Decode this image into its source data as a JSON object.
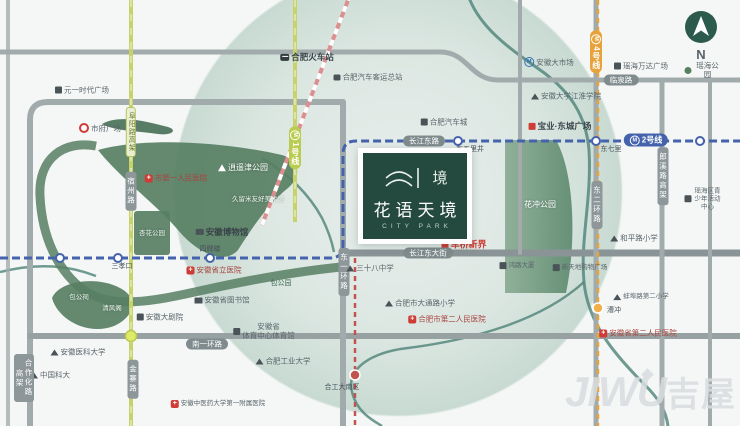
{
  "project": {
    "name_cn": "花语天境",
    "name_en": "CITY PARK",
    "glyph_char": "境"
  },
  "compass": {
    "label": "N"
  },
  "watermark": {
    "en": "JIWU",
    "cn": "吉屋"
  },
  "colors": {
    "brand_green": "#24493f",
    "circle_tint": "#a9c6ba",
    "park_green": "#577f63",
    "road_gray": "#a2abac",
    "road_dark": "#7f8b8d",
    "metro_blue": "#4463ac",
    "line4_orange": "#e7a33b",
    "line5_red": "#c25450",
    "elevated_olive": "#c7d26a",
    "poi_red": "#cf3b35",
    "water_teal": "#4e8277"
  },
  "map": {
    "labels": [
      {
        "n": "hefei-railway-station",
        "t": "合肥火车站",
        "x": 307,
        "y": 57,
        "c": "poi-strong",
        "i": "train"
      },
      {
        "n": "coach-terminal",
        "t": "合肥汽车客运总站",
        "x": 368,
        "y": 77,
        "i": "bus"
      },
      {
        "n": "yuanyi-plaza",
        "t": "元一时代广场",
        "x": 82,
        "y": 90,
        "i": "building"
      },
      {
        "n": "city-hall-square",
        "t": "市府广场",
        "x": 100,
        "y": 128,
        "i": "target"
      },
      {
        "n": "anhui-big-market",
        "t": "安徽大市场",
        "x": 549,
        "y": 62,
        "i": "metro"
      },
      {
        "n": "yaohai-wanda-plaza",
        "t": "瑶海万达广场",
        "x": 641,
        "y": 66,
        "i": "building"
      },
      {
        "n": "yaohai-park",
        "t": "瑶海公园",
        "x": 703,
        "y": 70,
        "i": "tree"
      },
      {
        "n": "linquan-road-box",
        "t": "临泉路",
        "x": 621,
        "y": 80,
        "c": "roadbox"
      },
      {
        "n": "anhui-univ-jianghuai-college",
        "t": "安徽大学江淮学院",
        "x": 566,
        "y": 96,
        "i": "school"
      },
      {
        "n": "hefei-auto-city",
        "t": "合肥汽车城",
        "x": 444,
        "y": 122,
        "i": "building"
      },
      {
        "n": "baoye-dongcheng-plaza",
        "t": "宝业·东城广场",
        "x": 560,
        "y": 126,
        "c": "poi-strong",
        "i": "building-red"
      },
      {
        "n": "line1-badge",
        "t": "1号线",
        "x": 295,
        "y": 148,
        "c": "badge-olive-v",
        "i": "m-white"
      },
      {
        "n": "fuyang-elevated-box",
        "t": "阜阳路高架",
        "x": 131,
        "y": 132,
        "c": "roadbox-olive-v"
      },
      {
        "n": "changjiang-east-road-box",
        "t": "长江东路",
        "x": 424,
        "y": 141,
        "c": "roadbox"
      },
      {
        "n": "line2-badge",
        "t": "2号线",
        "x": 646,
        "y": 140,
        "c": "badge-blue",
        "i": "m-white"
      },
      {
        "n": "dongqili-station-label",
        "t": "东七里",
        "x": 611,
        "y": 150,
        "c": "station"
      },
      {
        "n": "dongwulijing-station-label",
        "t": "东五里井",
        "x": 470,
        "y": 150,
        "c": "station"
      },
      {
        "n": "line4-badge",
        "t": "4号线",
        "x": 596,
        "y": 52,
        "c": "badge-orange-v",
        "i": "m-white"
      },
      {
        "n": "huachong-park-label",
        "t": "花冲公园",
        "x": 540,
        "y": 205,
        "c": "park"
      },
      {
        "n": "yaohai-youth-center",
        "t": "瑶海区青少年活动中心",
        "x": 703,
        "y": 199,
        "c": "tiny",
        "i": "building"
      },
      {
        "n": "langxi-elevated-box",
        "t": "郎溪路高架",
        "x": 663,
        "y": 176,
        "c": "roadbox-v"
      },
      {
        "n": "east-2nd-ring-box",
        "t": "东二环路",
        "x": 597,
        "y": 205,
        "c": "roadbox-v"
      },
      {
        "n": "east-1st-ring-box",
        "t": "东一环路",
        "x": 344,
        "y": 272,
        "c": "roadbox-v"
      },
      {
        "n": "suzhou-road-box",
        "t": "宿州路",
        "x": 131,
        "y": 191,
        "c": "roadbox-v"
      },
      {
        "n": "xiaoyaojin-park-label",
        "t": "逍遥津公园",
        "x": 243,
        "y": 168,
        "c": "park",
        "i": "tree-white"
      },
      {
        "n": "kurume-art-museum",
        "t": "久留米友好美术馆",
        "x": 258,
        "y": 200,
        "c": "park-sub"
      },
      {
        "n": "hefei-1st-peoples-hospital",
        "t": "市第一人民医院",
        "x": 176,
        "y": 178,
        "c": "poi-red",
        "i": "hospital"
      },
      {
        "n": "xinghua-park-label",
        "t": "杏花公园",
        "x": 152,
        "y": 234,
        "c": "park-sub"
      },
      {
        "n": "anhui-museum",
        "t": "安徽博物馆",
        "x": 222,
        "y": 232,
        "c": "poi-strong",
        "i": "museum"
      },
      {
        "n": "cheqiao-xinjie",
        "t": "车桥新界",
        "x": 464,
        "y": 245,
        "c": "red-strong",
        "i": "building-red"
      },
      {
        "n": "changjiang-east-avenue-box",
        "t": "长江东大街",
        "x": 428,
        "y": 253,
        "c": "roadbox"
      },
      {
        "n": "no38-middle-school",
        "t": "三十八中学",
        "x": 370,
        "y": 268,
        "i": "school"
      },
      {
        "n": "honglu-tower",
        "t": "鸿路大厦",
        "x": 517,
        "y": 266,
        "c": "tiny",
        "i": "building"
      },
      {
        "n": "xintiandi-mall",
        "t": "新天地购物广场",
        "x": 580,
        "y": 268,
        "c": "tiny",
        "i": "building"
      },
      {
        "n": "heping-road-primary",
        "t": "和平路小学",
        "x": 634,
        "y": 238,
        "i": "school"
      },
      {
        "n": "bengbu-road-2nd-primary",
        "t": "蚌埠路第二小学",
        "x": 641,
        "y": 297,
        "c": "tiny",
        "i": "school"
      },
      {
        "n": "datong-road-primary",
        "t": "合肥市大通路小学",
        "x": 420,
        "y": 303,
        "i": "school"
      },
      {
        "n": "hefei-2nd-peoples-hospital",
        "t": "合肥市第二人民医院",
        "x": 447,
        "y": 319,
        "c": "poi-red",
        "i": "hospital"
      },
      {
        "n": "anhui-2nd-peoples-hospital",
        "t": "安徽省第二人民医院",
        "x": 638,
        "y": 333,
        "c": "poi-red",
        "i": "hospital"
      },
      {
        "n": "caochong-station-label",
        "t": "漕冲",
        "x": 614,
        "y": 311,
        "c": "station"
      },
      {
        "n": "anhui-provincial-hospital",
        "t": "安徽省立医院",
        "x": 214,
        "y": 270,
        "c": "poi-red",
        "i": "hospital"
      },
      {
        "n": "sipailou-station-label",
        "t": "四牌楼",
        "x": 210,
        "y": 250,
        "c": "station"
      },
      {
        "n": "sanxiaokou-station-label",
        "t": "三孝口",
        "x": 122,
        "y": 267,
        "c": "station"
      },
      {
        "n": "anhui-library",
        "t": "安徽省图书馆",
        "x": 222,
        "y": 300,
        "i": "museum"
      },
      {
        "n": "baogong-park-label",
        "t": "包公园",
        "x": 281,
        "y": 284,
        "c": "park-dark"
      },
      {
        "n": "baogong-temple-label",
        "t": "包公祠",
        "x": 79,
        "y": 298,
        "c": "park-sub"
      },
      {
        "n": "qingfeng-pavilion-label",
        "t": "清风阁",
        "x": 112,
        "y": 309,
        "c": "park-sub"
      },
      {
        "n": "anhui-grand-theatre",
        "t": "安徽大剧院",
        "x": 160,
        "y": 317,
        "i": "building"
      },
      {
        "n": "sports-center-gym",
        "t": "安徽省\n体育中心体育馆",
        "x": 264,
        "y": 331,
        "i": "building"
      },
      {
        "n": "south-1st-ring-box",
        "t": "南一环路",
        "x": 207,
        "y": 344,
        "c": "roadbox"
      },
      {
        "n": "hefei-univ-tech",
        "t": "合肥工业大学",
        "x": 283,
        "y": 361,
        "i": "school"
      },
      {
        "n": "hgd-south-station-label",
        "t": "合工大南区",
        "x": 342,
        "y": 388,
        "c": "station"
      },
      {
        "n": "anhui-medical-univ",
        "t": "安徽医科大学",
        "x": 78,
        "y": 352,
        "i": "school"
      },
      {
        "n": "ustc",
        "t": "中国科大",
        "x": 50,
        "y": 375,
        "i": "school"
      },
      {
        "n": "tcm-univ-hospital",
        "t": "安徽中医药大学第一附属医院",
        "x": 218,
        "y": 404,
        "c": "tiny",
        "i": "hospital"
      },
      {
        "n": "jinzhai-road-box",
        "t": "金寨路",
        "x": 133,
        "y": 379,
        "c": "roadbox-v"
      },
      {
        "n": "hezuohua-elevated-box",
        "t": "合作化路高架",
        "x": 24,
        "y": 378,
        "c": "roadbox-v"
      }
    ]
  }
}
